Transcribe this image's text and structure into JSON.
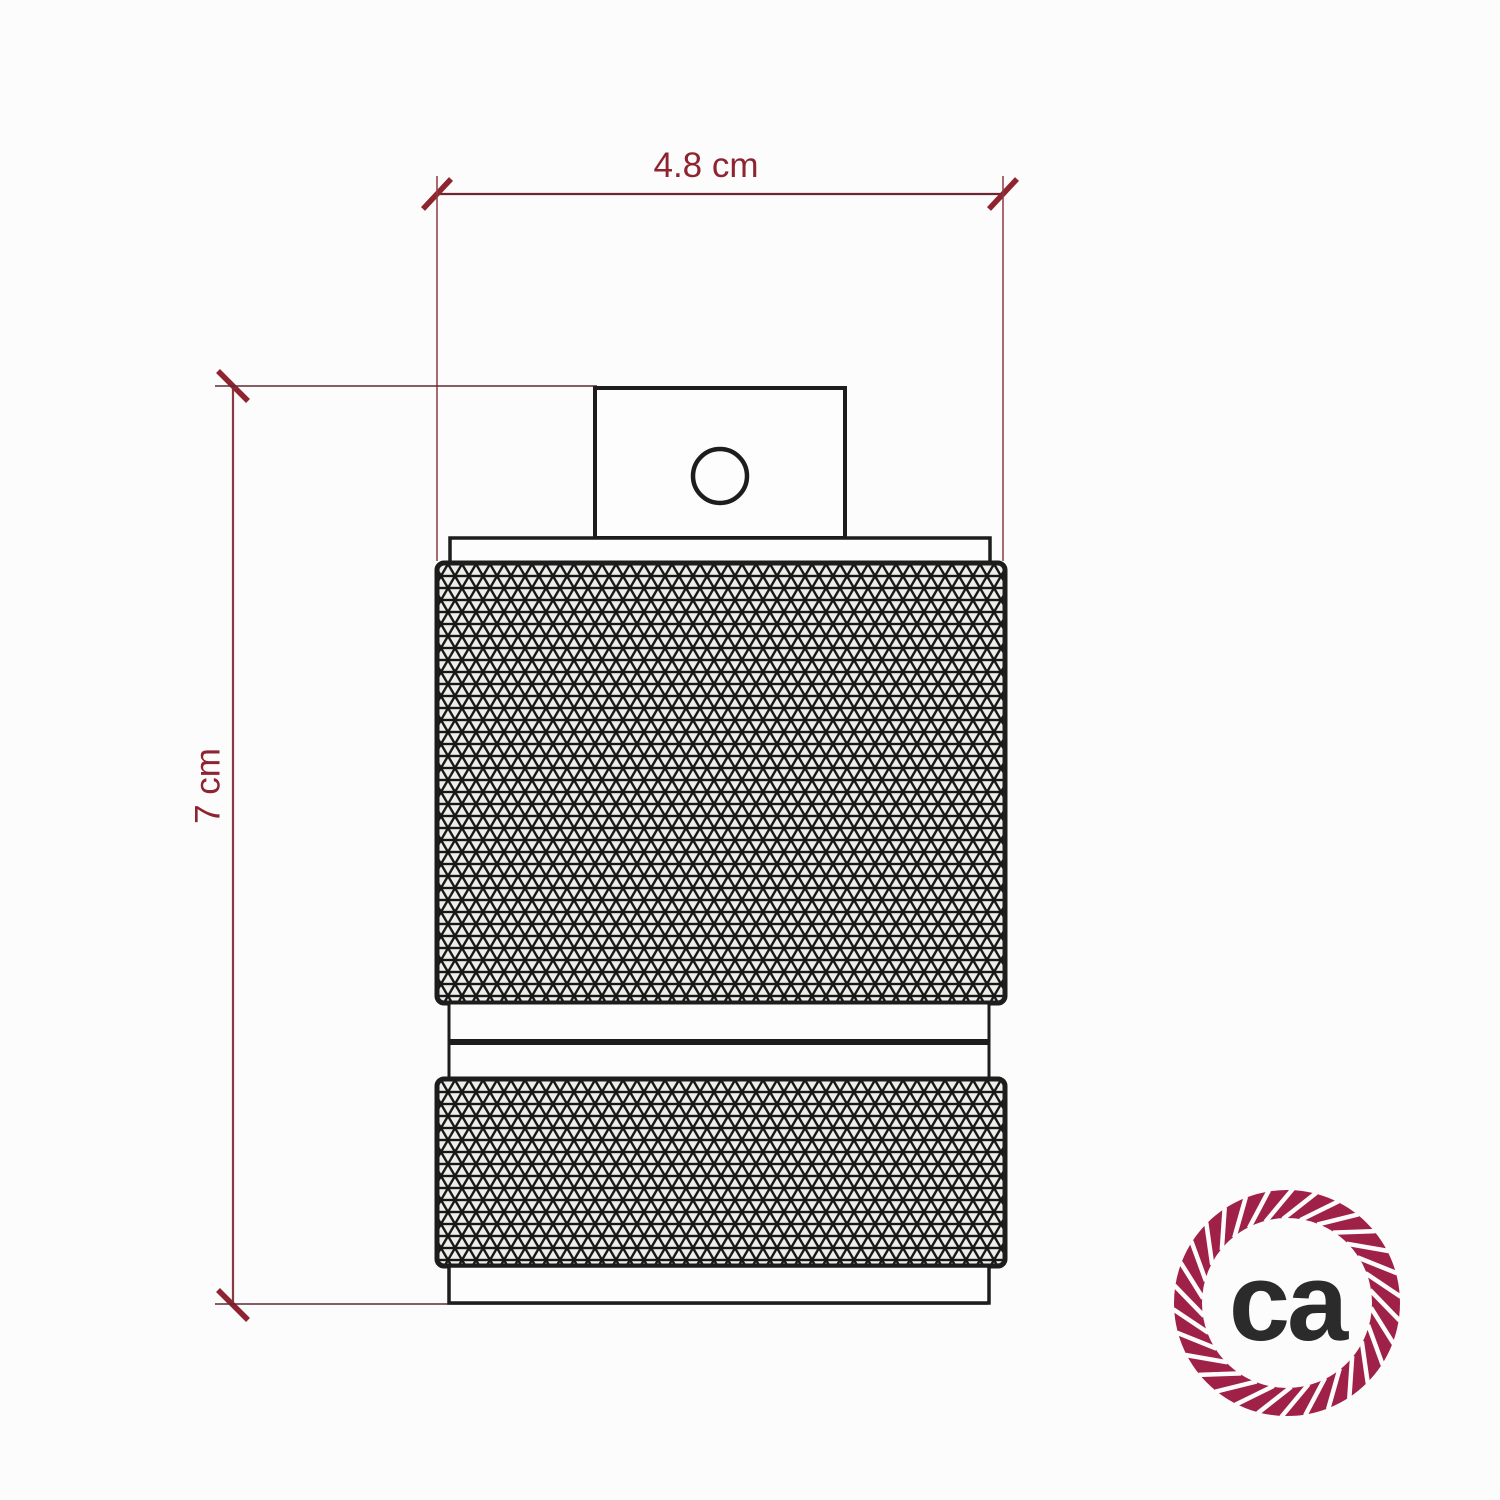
{
  "dimensions": {
    "width_label": "4.8 cm",
    "height_label": "7 cm"
  },
  "logo": {
    "text": "ca"
  },
  "colors": {
    "dimension_red": "#8e2430",
    "tick_red": "#98202e",
    "line_black": "#1d1d1d",
    "rope_crimson": "#9f2147",
    "logo_text_gray": "#2b2b2b",
    "background": "#fcfcfc"
  }
}
